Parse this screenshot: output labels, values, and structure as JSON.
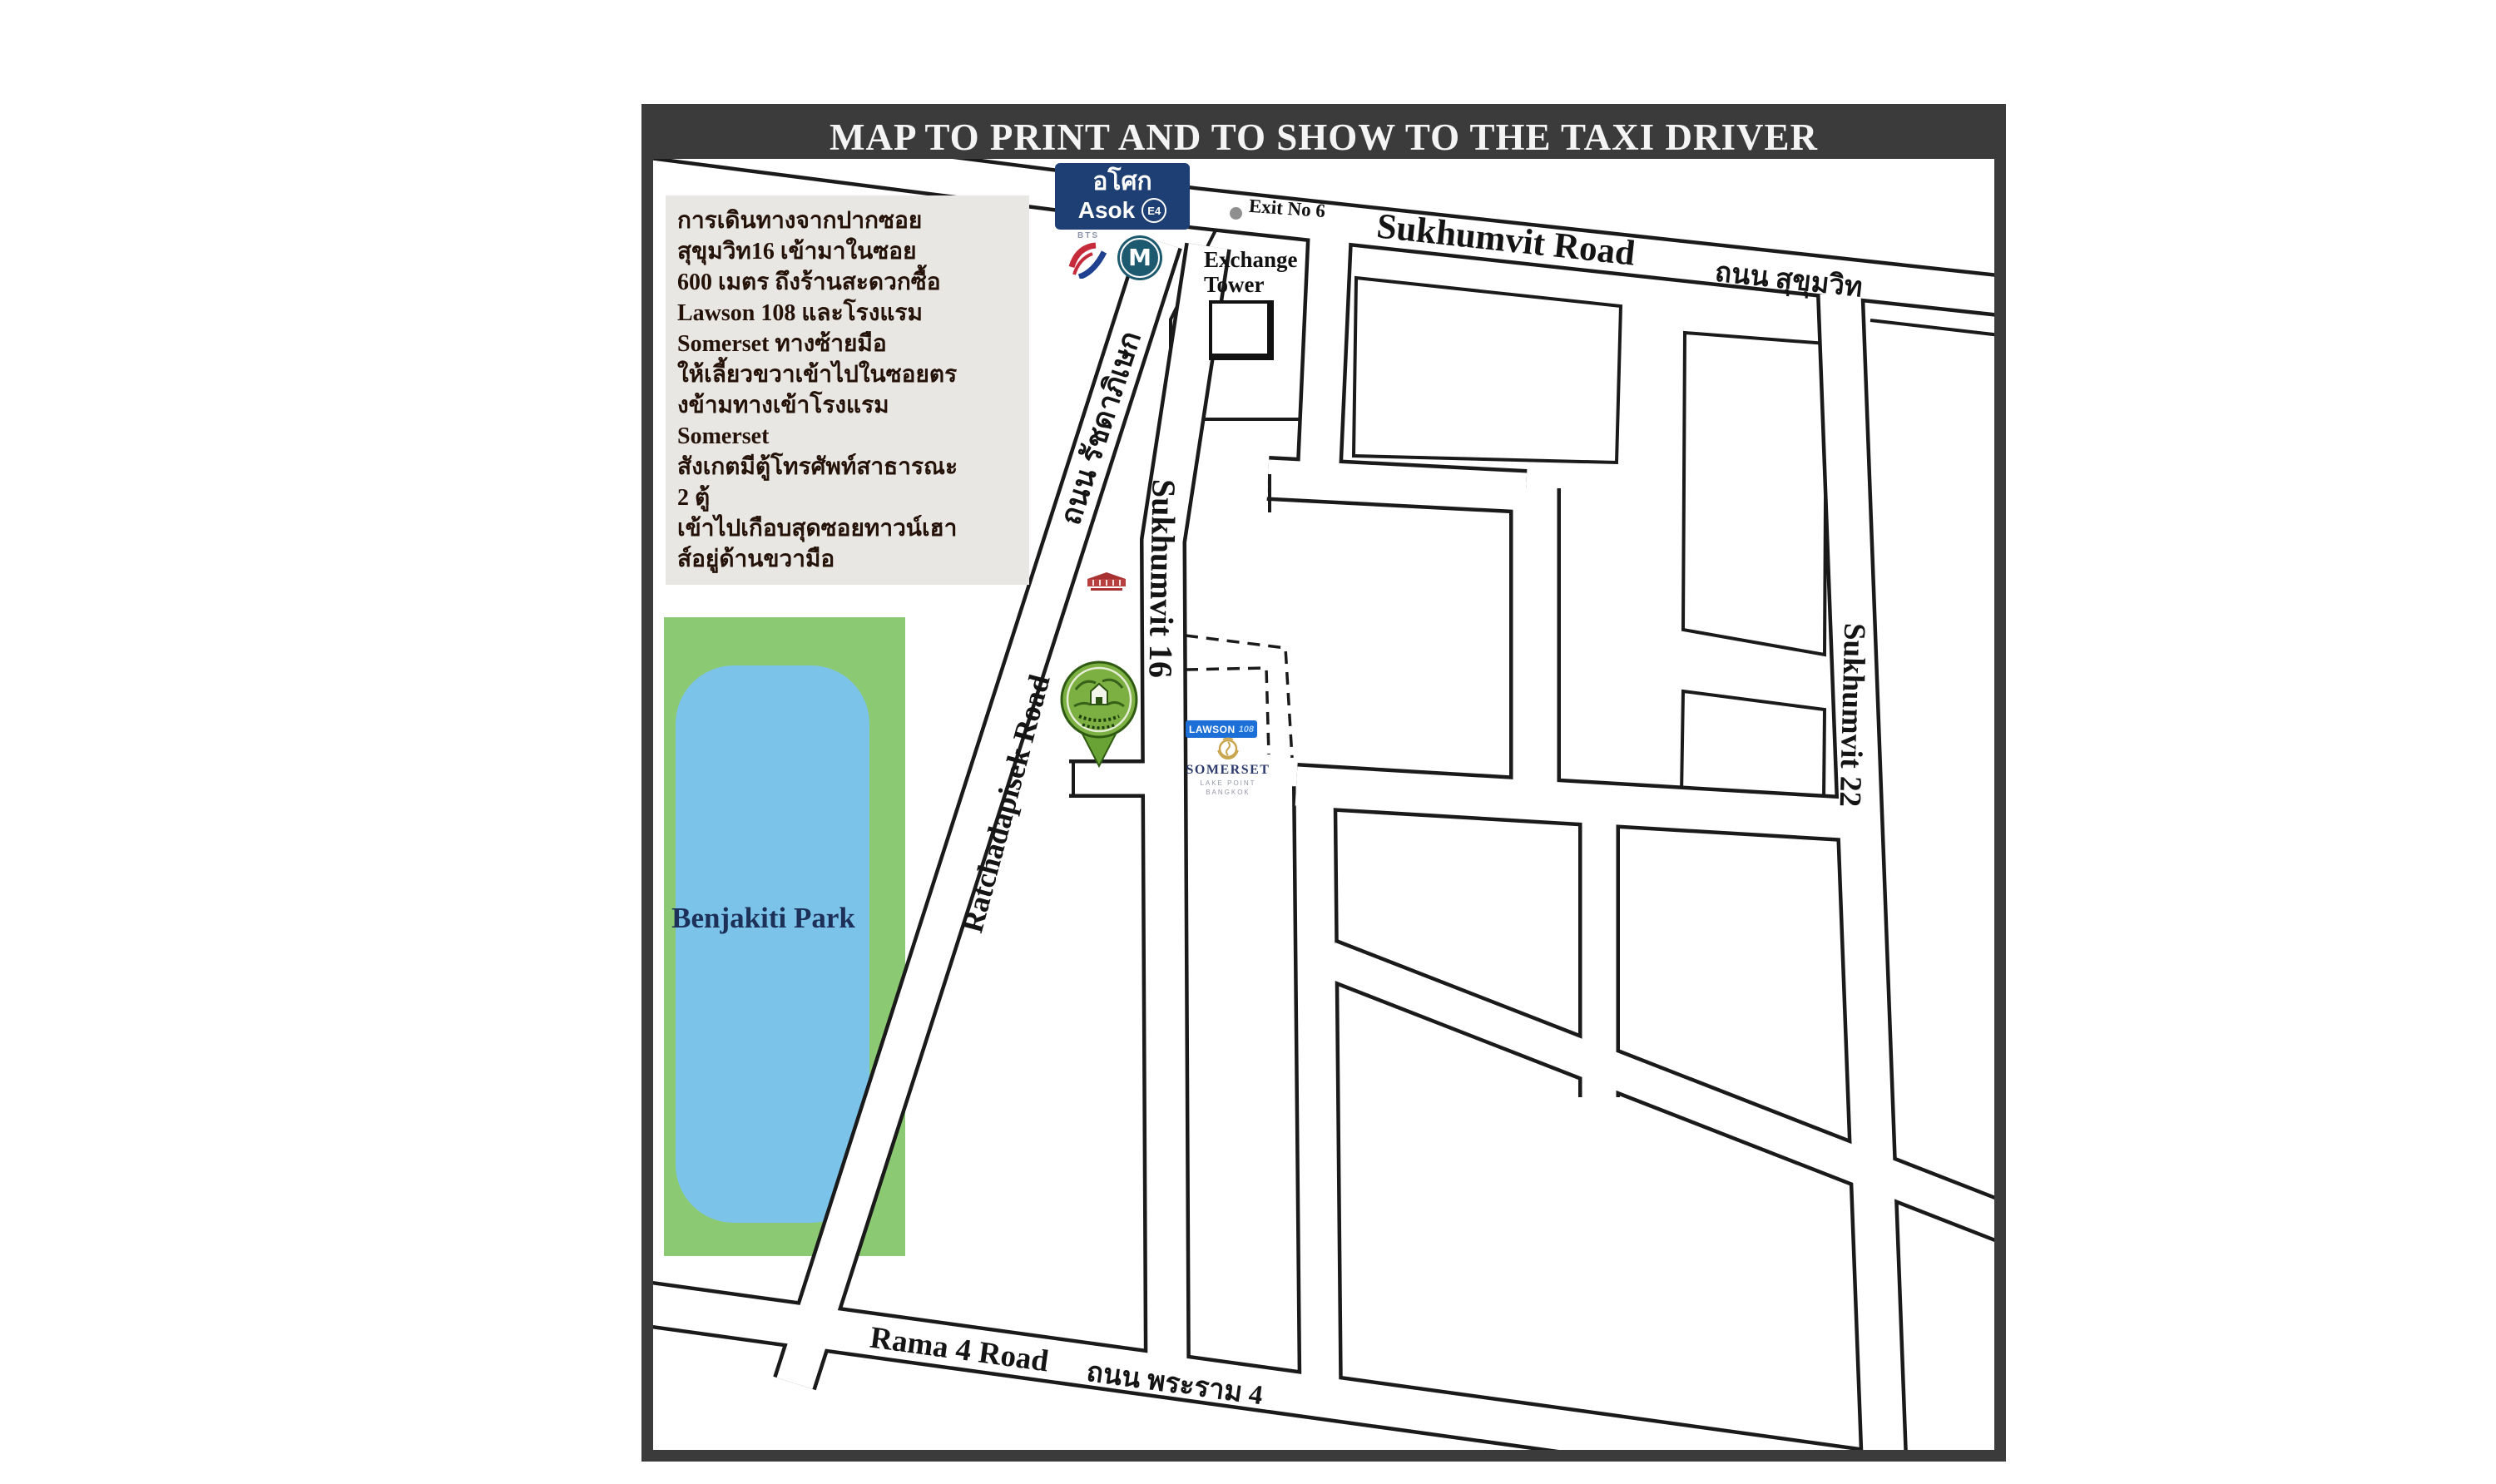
{
  "title": "MAP TO PRINT AND TO SHOW TO THE TAXI DRIVER",
  "instructions": {
    "lines": [
      "การเดินทางจากปากซอย",
      "สุขุมวิท16 เข้ามาในซอย",
      "600 เมตร ถึงร้านสะดวกซื้อ",
      "Lawson 108 และโรงแรม",
      "Somerset ทางซ้ายมือ",
      "ให้เลี้ยวขวาเข้าไปในซอยตร",
      "งข้ามทางเข้าโรงแรม",
      "Somerset",
      "สังเกตมีตู้โทรศัพท์สาธารณะ",
      "2 ตู้",
      "เข้าไปเกือบสุดซอยทาวน์เฮา",
      "ส์อยู่ด้านขวามือ"
    ]
  },
  "station": {
    "name_thai": "อโศก",
    "name_en": "Asok",
    "code": "E4",
    "bts_label": "BTS",
    "mrt_label": "M"
  },
  "map_labels": {
    "exit": "Exit No 6",
    "exchange_tower_line1": "Exchange",
    "exchange_tower_line2": "Tower",
    "sukhumvit_road_en": "Sukhumvit Road",
    "sukhumvit_road_thai": "ถนน สุขุมวิท",
    "sukhumvit_16": "Sukhumvit 16",
    "sukhumvit_22": "Sukhumvit 22",
    "ratchadapisek_thai": "ถนน รัชดาภิเษก",
    "ratchadapisek_en": "Ratchadapisek Road",
    "rama4_en": "Rama 4 Road",
    "rama4_thai": "ถนน พระราม 4",
    "benjakiti_park": "Benjakiti Park"
  },
  "pois": {
    "lawson_name": "LAWSON",
    "lawson_number": "108",
    "somerset_name": "SOMERSET",
    "somerset_sub1": "LAKE POINT",
    "somerset_sub2": "BANGKOK"
  },
  "colors": {
    "frame": "#3b3b3b",
    "station_badge_blue": "#1e3f73",
    "mrt_teal": "#1d5a70",
    "bts_red": "#c62b3c",
    "bts_blue": "#20418f",
    "park_green": "#8cc973",
    "lake_blue": "#7cc3ea",
    "lawson_blue": "#1b6fd6",
    "somerset_navy": "#2c3a6b",
    "somerset_gold": "#c9a550",
    "pin_green": "#7cb043",
    "red_logo": "#a83232",
    "road_outline": "#1a1a1a",
    "instructions_bg": "#e9e7e4"
  }
}
